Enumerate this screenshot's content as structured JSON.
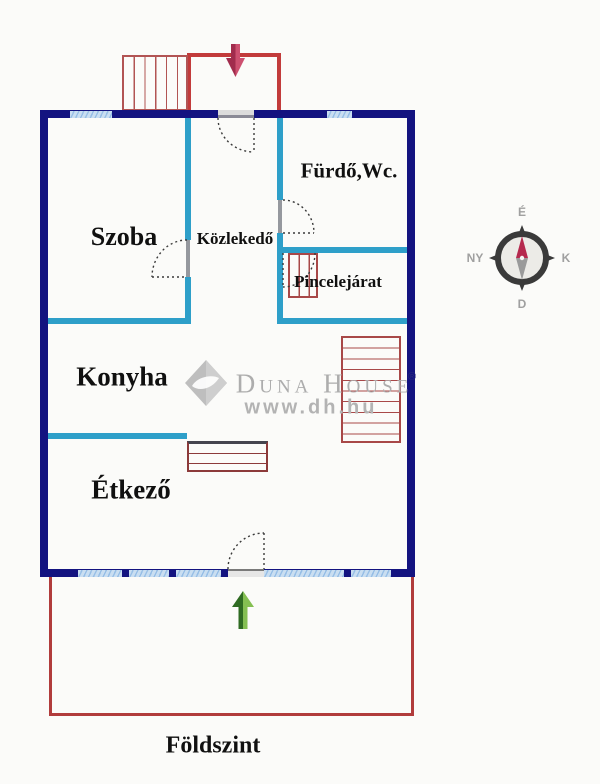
{
  "floorplan": {
    "floor_label": "Földszint",
    "rooms": {
      "szoba": "Szoba",
      "kozlekedo": "Közlekedő",
      "furdo_wc": "Fürdő,Wc.",
      "pincelejarat": "Pincelejárat",
      "konyha": "Konyha",
      "etkezo": "Étkező"
    },
    "compass": {
      "north": "É",
      "east": "K",
      "south": "D",
      "west": "NY"
    },
    "watermark": {
      "brand": "Duna House",
      "website": "www.dh.hu",
      "registered": "®"
    },
    "colors": {
      "exterior_wall": "#131380",
      "partition_wall": "#2e9fc9",
      "window": "#bcd9f2",
      "outline_red": "#c23b3b",
      "arrow_red": "#cd5070",
      "arrow_green": "#84bf52"
    }
  }
}
